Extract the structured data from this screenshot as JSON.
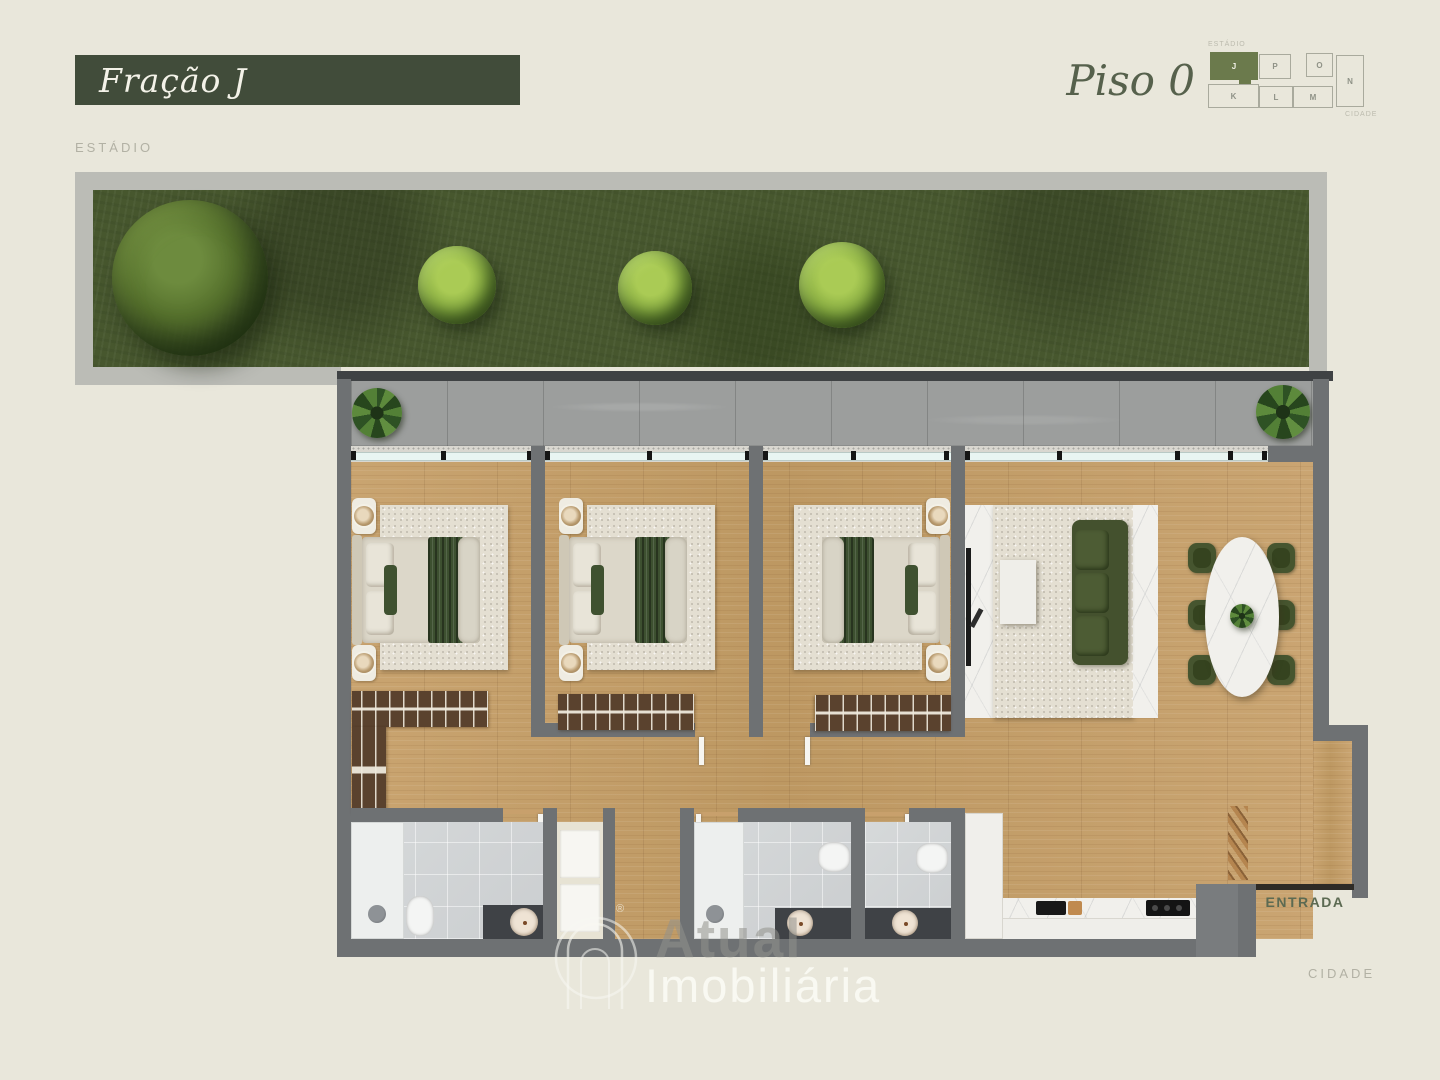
{
  "header": {
    "fraction_label": "Fração J",
    "floor_label": "Piso 0"
  },
  "orientation": {
    "top": "ESTÁDIO",
    "bottom": "CIDADE"
  },
  "minimap": {
    "top_label": "ESTÁDIO",
    "bottom_label": "CIDADE",
    "highlighted_unit": "J",
    "units": [
      {
        "label": "J",
        "highlighted": true
      },
      {
        "label": "P",
        "highlighted": false
      },
      {
        "label": "O",
        "highlighted": false
      },
      {
        "label": "N",
        "highlighted": false
      },
      {
        "label": "K",
        "highlighted": false
      },
      {
        "label": "L",
        "highlighted": false
      },
      {
        "label": "M",
        "highlighted": false
      }
    ]
  },
  "plan": {
    "entrance_label": "ENTRADA"
  },
  "watermark": {
    "name": "Atual",
    "type": "Imobiliária",
    "registered": "®"
  },
  "colors": {
    "background": "#E9E7DB",
    "banner_green": "#414C3A",
    "unit_highlight_green": "#6B7A4C",
    "wall_gray": "#6E7173",
    "wood_floor": "#C6A06C",
    "grass_green": "#47572E",
    "accent_text_green": "#56614C"
  }
}
